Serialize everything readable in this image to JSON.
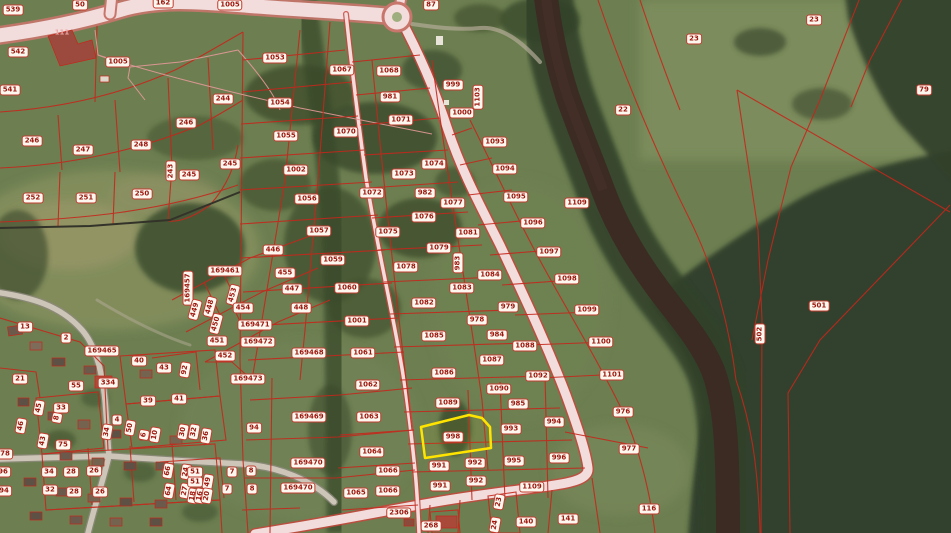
{
  "map": {
    "type_label": "cadastral-aerial-map",
    "colors": {
      "field": "#6d7f51",
      "forest": "#364528",
      "river": "#3c2b22",
      "road_fill": "#f3dcdc",
      "road_edge": "#c8463c",
      "cadastral_line": "#c5271c",
      "label_bg": "#fcf8f0",
      "label_text": "#9c150c",
      "selection": "#ffe400"
    },
    "selected_parcel": {
      "number": "998",
      "outline_color": "#ffe400",
      "polygon": "421,427 469,415 482,418 490,427 491,448 425,458"
    },
    "parcel_labels": [
      {
        "t": "539",
        "x": 13,
        "y": 10
      },
      {
        "t": "50",
        "x": 80,
        "y": 5
      },
      {
        "t": "162",
        "x": 163,
        "y": 3
      },
      {
        "t": "1005",
        "x": 230,
        "y": 5
      },
      {
        "t": "542",
        "x": 18,
        "y": 52
      },
      {
        "t": "541",
        "x": 10,
        "y": 90
      },
      {
        "t": "111",
        "x": 62,
        "y": 33,
        "pink": true
      },
      {
        "t": "1005",
        "x": 118,
        "y": 62
      },
      {
        "t": "244",
        "x": 223,
        "y": 99
      },
      {
        "t": "246",
        "x": 186,
        "y": 123
      },
      {
        "t": "246",
        "x": 32,
        "y": 141
      },
      {
        "t": "247",
        "x": 83,
        "y": 150
      },
      {
        "t": "248",
        "x": 141,
        "y": 145
      },
      {
        "t": "245",
        "x": 230,
        "y": 164
      },
      {
        "t": "245",
        "x": 189,
        "y": 175
      },
      {
        "t": "243",
        "x": 171,
        "y": 171,
        "r": -90
      },
      {
        "t": "252",
        "x": 33,
        "y": 198
      },
      {
        "t": "251",
        "x": 86,
        "y": 198
      },
      {
        "t": "250",
        "x": 142,
        "y": 194
      },
      {
        "t": "87",
        "x": 431,
        "y": 5
      },
      {
        "t": "23",
        "x": 694,
        "y": 39
      },
      {
        "t": "23",
        "x": 814,
        "y": 20
      },
      {
        "t": "79",
        "x": 924,
        "y": 90
      },
      {
        "t": "22",
        "x": 623,
        "y": 110
      },
      {
        "t": "1053",
        "x": 275,
        "y": 58
      },
      {
        "t": "1067",
        "x": 342,
        "y": 70
      },
      {
        "t": "1068",
        "x": 389,
        "y": 71
      },
      {
        "t": "999",
        "x": 453,
        "y": 85
      },
      {
        "t": "981",
        "x": 390,
        "y": 97
      },
      {
        "t": "1054",
        "x": 280,
        "y": 103
      },
      {
        "t": "1000",
        "x": 462,
        "y": 113
      },
      {
        "t": "1071",
        "x": 401,
        "y": 120
      },
      {
        "t": "1103",
        "x": 478,
        "y": 97,
        "r": -90
      },
      {
        "t": "1055",
        "x": 286,
        "y": 136
      },
      {
        "t": "1070",
        "x": 346,
        "y": 132
      },
      {
        "t": "1002",
        "x": 296,
        "y": 170
      },
      {
        "t": "1074",
        "x": 434,
        "y": 164
      },
      {
        "t": "1073",
        "x": 404,
        "y": 174
      },
      {
        "t": "1093",
        "x": 495,
        "y": 142
      },
      {
        "t": "1094",
        "x": 505,
        "y": 169
      },
      {
        "t": "1095",
        "x": 516,
        "y": 197
      },
      {
        "t": "1109",
        "x": 577,
        "y": 203
      },
      {
        "t": "1096",
        "x": 533,
        "y": 223
      },
      {
        "t": "1097",
        "x": 549,
        "y": 252
      },
      {
        "t": "1098",
        "x": 567,
        "y": 279
      },
      {
        "t": "1099",
        "x": 587,
        "y": 310
      },
      {
        "t": "1100",
        "x": 601,
        "y": 342
      },
      {
        "t": "1101",
        "x": 612,
        "y": 375
      },
      {
        "t": "976",
        "x": 623,
        "y": 412
      },
      {
        "t": "977",
        "x": 629,
        "y": 449
      },
      {
        "t": "116",
        "x": 649,
        "y": 509
      },
      {
        "t": "140",
        "x": 526,
        "y": 522
      },
      {
        "t": "141",
        "x": 568,
        "y": 519
      },
      {
        "t": "501",
        "x": 819,
        "y": 306
      },
      {
        "t": "502",
        "x": 760,
        "y": 334,
        "r": -90
      },
      {
        "t": "1056",
        "x": 307,
        "y": 199
      },
      {
        "t": "1072",
        "x": 372,
        "y": 193
      },
      {
        "t": "982",
        "x": 425,
        "y": 193
      },
      {
        "t": "1077",
        "x": 453,
        "y": 203
      },
      {
        "t": "1076",
        "x": 424,
        "y": 217
      },
      {
        "t": "1057",
        "x": 319,
        "y": 231
      },
      {
        "t": "1075",
        "x": 388,
        "y": 232
      },
      {
        "t": "1081",
        "x": 468,
        "y": 233
      },
      {
        "t": "1079",
        "x": 439,
        "y": 248
      },
      {
        "t": "446",
        "x": 273,
        "y": 250
      },
      {
        "t": "1059",
        "x": 333,
        "y": 260
      },
      {
        "t": "983",
        "x": 458,
        "y": 263,
        "r": -90
      },
      {
        "t": "1078",
        "x": 406,
        "y": 267
      },
      {
        "t": "455",
        "x": 285,
        "y": 273
      },
      {
        "t": "169461",
        "x": 225,
        "y": 271
      },
      {
        "t": "1084",
        "x": 490,
        "y": 275
      },
      {
        "t": "169457",
        "x": 188,
        "y": 288,
        "r": -90
      },
      {
        "t": "447",
        "x": 292,
        "y": 289
      },
      {
        "t": "1060",
        "x": 347,
        "y": 288
      },
      {
        "t": "1083",
        "x": 462,
        "y": 288
      },
      {
        "t": "453",
        "x": 233,
        "y": 295,
        "r": -75
      },
      {
        "t": "449",
        "x": 195,
        "y": 310,
        "r": -75
      },
      {
        "t": "448",
        "x": 210,
        "y": 307,
        "r": -75
      },
      {
        "t": "448",
        "x": 301,
        "y": 308
      },
      {
        "t": "1082",
        "x": 424,
        "y": 303
      },
      {
        "t": "454",
        "x": 243,
        "y": 308
      },
      {
        "t": "979",
        "x": 508,
        "y": 307
      },
      {
        "t": "450",
        "x": 216,
        "y": 324,
        "r": -75
      },
      {
        "t": "169471",
        "x": 255,
        "y": 325
      },
      {
        "t": "1001",
        "x": 357,
        "y": 321
      },
      {
        "t": "978",
        "x": 477,
        "y": 320
      },
      {
        "t": "13",
        "x": 25,
        "y": 327
      },
      {
        "t": "451",
        "x": 217,
        "y": 341
      },
      {
        "t": "169472",
        "x": 258,
        "y": 342
      },
      {
        "t": "1085",
        "x": 434,
        "y": 336
      },
      {
        "t": "984",
        "x": 497,
        "y": 335
      },
      {
        "t": "2",
        "x": 66,
        "y": 338
      },
      {
        "t": "452",
        "x": 225,
        "y": 356
      },
      {
        "t": "169468",
        "x": 309,
        "y": 353
      },
      {
        "t": "1061",
        "x": 363,
        "y": 353
      },
      {
        "t": "1088",
        "x": 525,
        "y": 346
      },
      {
        "t": "169465",
        "x": 102,
        "y": 351
      },
      {
        "t": "1087",
        "x": 492,
        "y": 360
      },
      {
        "t": "169473",
        "x": 248,
        "y": 379
      },
      {
        "t": "1086",
        "x": 444,
        "y": 373
      },
      {
        "t": "1062",
        "x": 368,
        "y": 385
      },
      {
        "t": "21",
        "x": 20,
        "y": 379
      },
      {
        "t": "55",
        "x": 76,
        "y": 386
      },
      {
        "t": "334",
        "x": 108,
        "y": 383
      },
      {
        "t": "40",
        "x": 139,
        "y": 361
      },
      {
        "t": "43",
        "x": 164,
        "y": 368
      },
      {
        "t": "92",
        "x": 185,
        "y": 370,
        "r": -80
      },
      {
        "t": "39",
        "x": 148,
        "y": 401
      },
      {
        "t": "41",
        "x": 179,
        "y": 399
      },
      {
        "t": "1089",
        "x": 448,
        "y": 403
      },
      {
        "t": "169469",
        "x": 309,
        "y": 417
      },
      {
        "t": "1063",
        "x": 369,
        "y": 417
      },
      {
        "t": "1090",
        "x": 499,
        "y": 389
      },
      {
        "t": "1092",
        "x": 538,
        "y": 376
      },
      {
        "t": "985",
        "x": 518,
        "y": 404
      },
      {
        "t": "45",
        "x": 39,
        "y": 408,
        "r": -80
      },
      {
        "t": "33",
        "x": 61,
        "y": 408
      },
      {
        "t": "8",
        "x": 57,
        "y": 418,
        "r": -80
      },
      {
        "t": "46",
        "x": 21,
        "y": 426,
        "r": -80
      },
      {
        "t": "4",
        "x": 117,
        "y": 420
      },
      {
        "t": "34",
        "x": 107,
        "y": 432,
        "r": -80
      },
      {
        "t": "50",
        "x": 130,
        "y": 428,
        "r": -80
      },
      {
        "t": "6",
        "x": 144,
        "y": 435,
        "r": -80
      },
      {
        "t": "10",
        "x": 155,
        "y": 435,
        "r": -80
      },
      {
        "t": "30",
        "x": 183,
        "y": 432,
        "r": -80
      },
      {
        "t": "32",
        "x": 194,
        "y": 432,
        "r": -80
      },
      {
        "t": "36",
        "x": 206,
        "y": 436,
        "r": -80
      },
      {
        "t": "43",
        "x": 43,
        "y": 441,
        "r": -80
      },
      {
        "t": "75",
        "x": 63,
        "y": 445
      },
      {
        "t": "78",
        "x": 5,
        "y": 454
      },
      {
        "t": "94",
        "x": 254,
        "y": 428
      },
      {
        "t": "993",
        "x": 511,
        "y": 429
      },
      {
        "t": "994",
        "x": 554,
        "y": 422
      },
      {
        "t": "1064",
        "x": 372,
        "y": 452
      },
      {
        "t": "169470",
        "x": 308,
        "y": 463
      },
      {
        "t": "991",
        "x": 439,
        "y": 466
      },
      {
        "t": "992",
        "x": 475,
        "y": 463
      },
      {
        "t": "995",
        "x": 514,
        "y": 461
      },
      {
        "t": "996",
        "x": 559,
        "y": 458
      },
      {
        "t": "96",
        "x": 3,
        "y": 472
      },
      {
        "t": "34",
        "x": 49,
        "y": 472
      },
      {
        "t": "28",
        "x": 71,
        "y": 472
      },
      {
        "t": "26",
        "x": 94,
        "y": 471
      },
      {
        "t": "66",
        "x": 168,
        "y": 471,
        "r": -80
      },
      {
        "t": "24",
        "x": 186,
        "y": 472,
        "r": -80
      },
      {
        "t": "51",
        "x": 195,
        "y": 472
      },
      {
        "t": "7",
        "x": 232,
        "y": 472
      },
      {
        "t": "8",
        "x": 251,
        "y": 471
      },
      {
        "t": "1066",
        "x": 388,
        "y": 471
      },
      {
        "t": "94",
        "x": 4,
        "y": 491
      },
      {
        "t": "32",
        "x": 50,
        "y": 490
      },
      {
        "t": "28",
        "x": 74,
        "y": 492
      },
      {
        "t": "26",
        "x": 100,
        "y": 492
      },
      {
        "t": "64",
        "x": 169,
        "y": 491,
        "r": -80
      },
      {
        "t": "27",
        "x": 185,
        "y": 491,
        "r": -80
      },
      {
        "t": "51",
        "x": 195,
        "y": 482
      },
      {
        "t": "49",
        "x": 208,
        "y": 482,
        "r": -80
      },
      {
        "t": "18",
        "x": 193,
        "y": 496,
        "r": -80
      },
      {
        "t": "16",
        "x": 200,
        "y": 496,
        "r": -80
      },
      {
        "t": "20",
        "x": 207,
        "y": 496,
        "r": -80
      },
      {
        "t": "7",
        "x": 227,
        "y": 489
      },
      {
        "t": "8",
        "x": 252,
        "y": 489
      },
      {
        "t": "169470",
        "x": 298,
        "y": 488
      },
      {
        "t": "991",
        "x": 440,
        "y": 486
      },
      {
        "t": "992",
        "x": 476,
        "y": 481
      },
      {
        "t": "1065",
        "x": 356,
        "y": 493
      },
      {
        "t": "1066",
        "x": 388,
        "y": 491
      },
      {
        "t": "23",
        "x": 499,
        "y": 502,
        "r": -80
      },
      {
        "t": "1109",
        "x": 532,
        "y": 487
      },
      {
        "t": "2306",
        "x": 399,
        "y": 513
      },
      {
        "t": "24",
        "x": 495,
        "y": 525,
        "r": -80
      },
      {
        "t": "268",
        "x": 431,
        "y": 526
      },
      {
        "t": "998",
        "x": 453,
        "y": 437
      }
    ]
  }
}
